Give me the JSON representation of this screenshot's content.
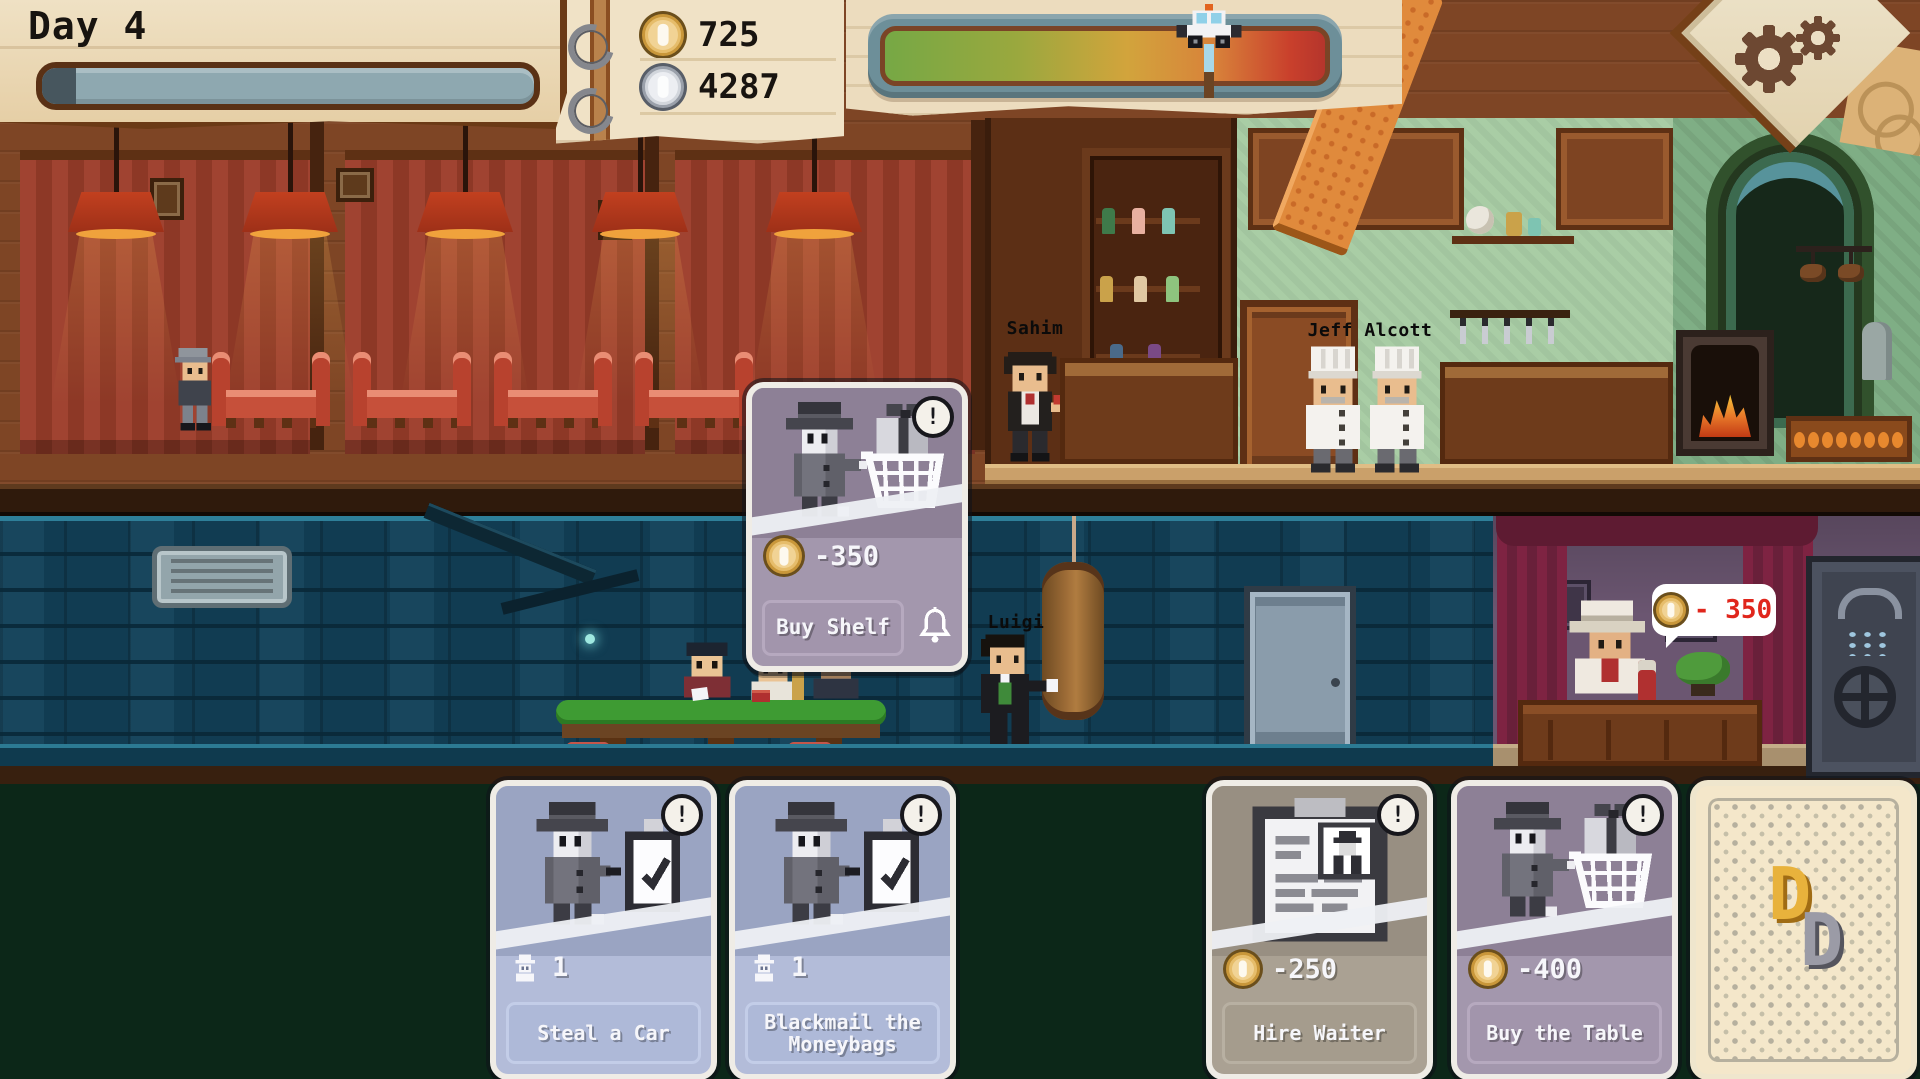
{
  "meta": {
    "title": "Mafia restaurant management game",
    "screen": "Day 4 — restaurant and basement view"
  },
  "hud": {
    "day_label": "Day 4",
    "day_progress_pct": 7,
    "gold_amount": "725",
    "silver_amount": "4287",
    "police_meter": {
      "marker_icon": "police-car-icon",
      "marker_pct": 72,
      "gradient": [
        "#76a845",
        "#9aa83e",
        "#d2a43c",
        "#d8823a",
        "#c9402c"
      ]
    },
    "settings_icon": "gear-icon"
  },
  "scene": {
    "bartender_name": "Sahim",
    "chefs_name": "Jeff Alcott",
    "basement_npc_name": "Luigi",
    "office_bubble_cost": "- 350"
  },
  "action_card": {
    "title": "Buy Shelf",
    "cost": "-350",
    "cost_icon": "gold-coin",
    "badge": "!",
    "reminder_icon": "bell-icon"
  },
  "hand_cards": [
    {
      "title": "Steal a Car",
      "cost": "1",
      "cost_icon": "person-icon",
      "badge": "!"
    },
    {
      "title": "Blackmail the Moneybags",
      "cost": "1",
      "cost_icon": "person-icon",
      "badge": "!"
    },
    {
      "title": "Hire Waiter",
      "cost": "-250",
      "cost_icon": "gold-coin",
      "badge": "!"
    },
    {
      "title": "Buy the Table",
      "cost": "-400",
      "cost_icon": "gold-coin",
      "badge": "!"
    },
    {
      "title": "",
      "type": "card-back",
      "monogram": [
        "D",
        "D"
      ]
    }
  ],
  "colors": {
    "paper": "#ecdcbe",
    "gold_coin": "#f1d395",
    "silver_coin": "#eceef2",
    "card_blue": "#9aa4c2",
    "card_taupe": "#988f82",
    "card_purple": "#8d8096",
    "cost_red": "#e0261c",
    "table_green": "#3e9b33",
    "basement_blue": "#113c52",
    "background_green": "#0c2718"
  }
}
